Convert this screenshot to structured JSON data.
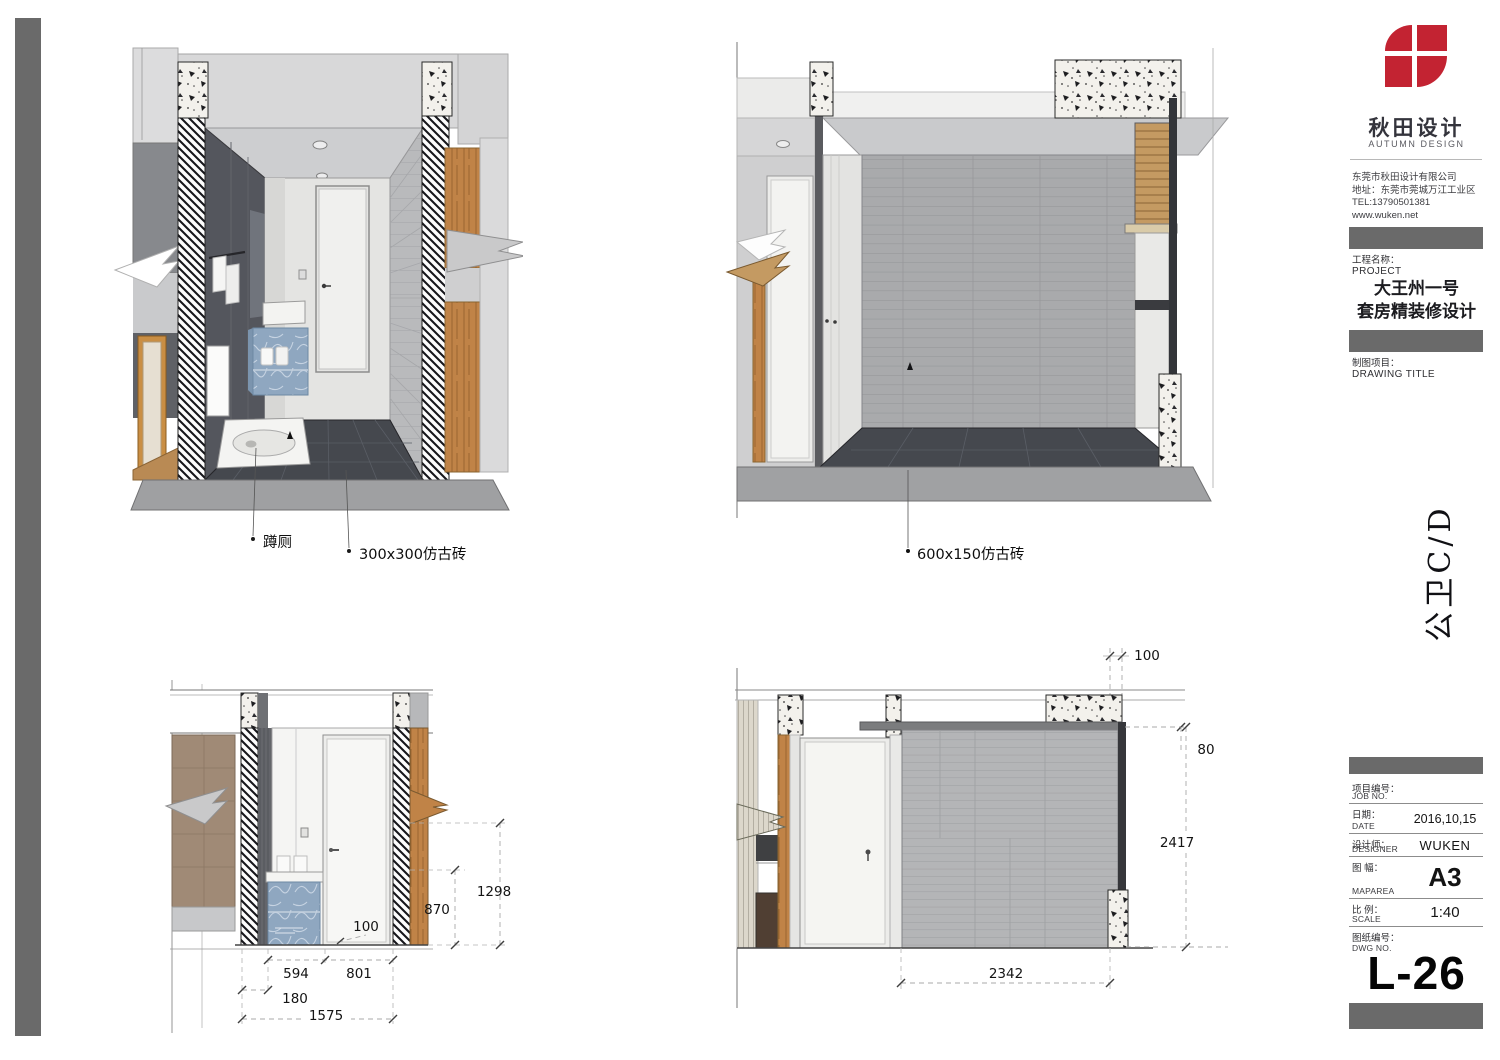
{
  "sheet": {
    "drawing_code_vertical": "公卫C/D",
    "edge_bar_color": "#6a6a6a"
  },
  "title_block": {
    "brand": {
      "logo_cn": "秋田设计",
      "logo_en": "AUTUMN DESIGN",
      "logo_color": "#c32332"
    },
    "company_lines": [
      "东莞市秋田设计有限公司",
      "地址：东莞市莞城万江工业区",
      "TEL:13790501381",
      "www.wuken.net"
    ],
    "project": {
      "label_cn": "工程名称：",
      "label_en": "PROJECT",
      "line1": "大王州一号",
      "line2": "套房精装修设计"
    },
    "drawing_title": {
      "label_cn": "制图项目：",
      "label_en": "DRAWING TITLE"
    },
    "fields": [
      {
        "cn": "项目编号：",
        "en": "JOB NO.",
        "value": ""
      },
      {
        "cn": "日期：",
        "en": "DATE",
        "value": "2016,10,15"
      },
      {
        "cn": "设计师：",
        "en": "DESIGNER",
        "value": "WUKEN"
      },
      {
        "cn": "图 幅：",
        "en": "MAPAREA",
        "value": "A3"
      },
      {
        "cn": "比 例：",
        "en": "SCALE",
        "value": "1:40"
      },
      {
        "cn": "图纸编号：",
        "en": "DWG NO.",
        "value": ""
      }
    ],
    "dwg_no": "L-26"
  },
  "annotations": {
    "squat_toilet": "蹲厕",
    "tile_300": "300x300仿古砖",
    "tile_600": "600x150仿古砖"
  },
  "dimensions": {
    "elev_left": {
      "v_1298": "1298",
      "v_870": "870",
      "note_100": "100",
      "h_594": "594",
      "h_801": "801",
      "h_180": "180",
      "h_1575": "1575"
    },
    "elev_right": {
      "top_100": "100",
      "off_80": "80",
      "v_2417": "2417",
      "h_2342": "2342"
    }
  }
}
